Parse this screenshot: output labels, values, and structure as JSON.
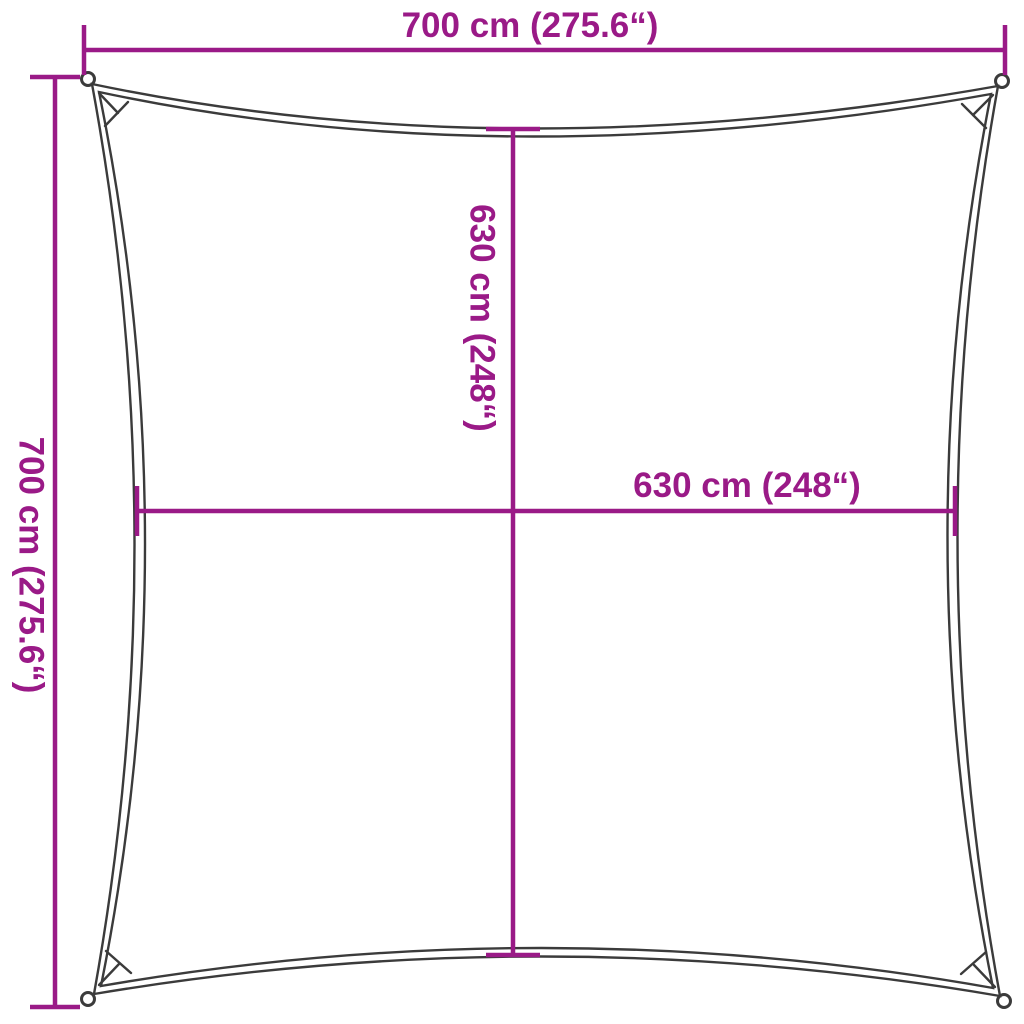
{
  "diagram": {
    "kind": "product-dimension-diagram",
    "subject": "square-shade-sail",
    "labels": {
      "top_width": "700 cm (275.6“)",
      "left_height": "700 cm (275.6“)",
      "center_height": "630 cm (248“)",
      "center_width": "630 cm (248“)"
    },
    "measurements": {
      "total_width_cm": 700,
      "total_width_inch": 275.6,
      "total_height_cm": 700,
      "total_height_inch": 275.6,
      "inner_width_cm": 630,
      "inner_width_inch": 248,
      "inner_height_cm": 630,
      "inner_height_inch": 248
    },
    "colors": {
      "dimension_line": "#9A1A87",
      "sail_outline": "#3B3B3B",
      "background": "#FFFFFF"
    }
  }
}
